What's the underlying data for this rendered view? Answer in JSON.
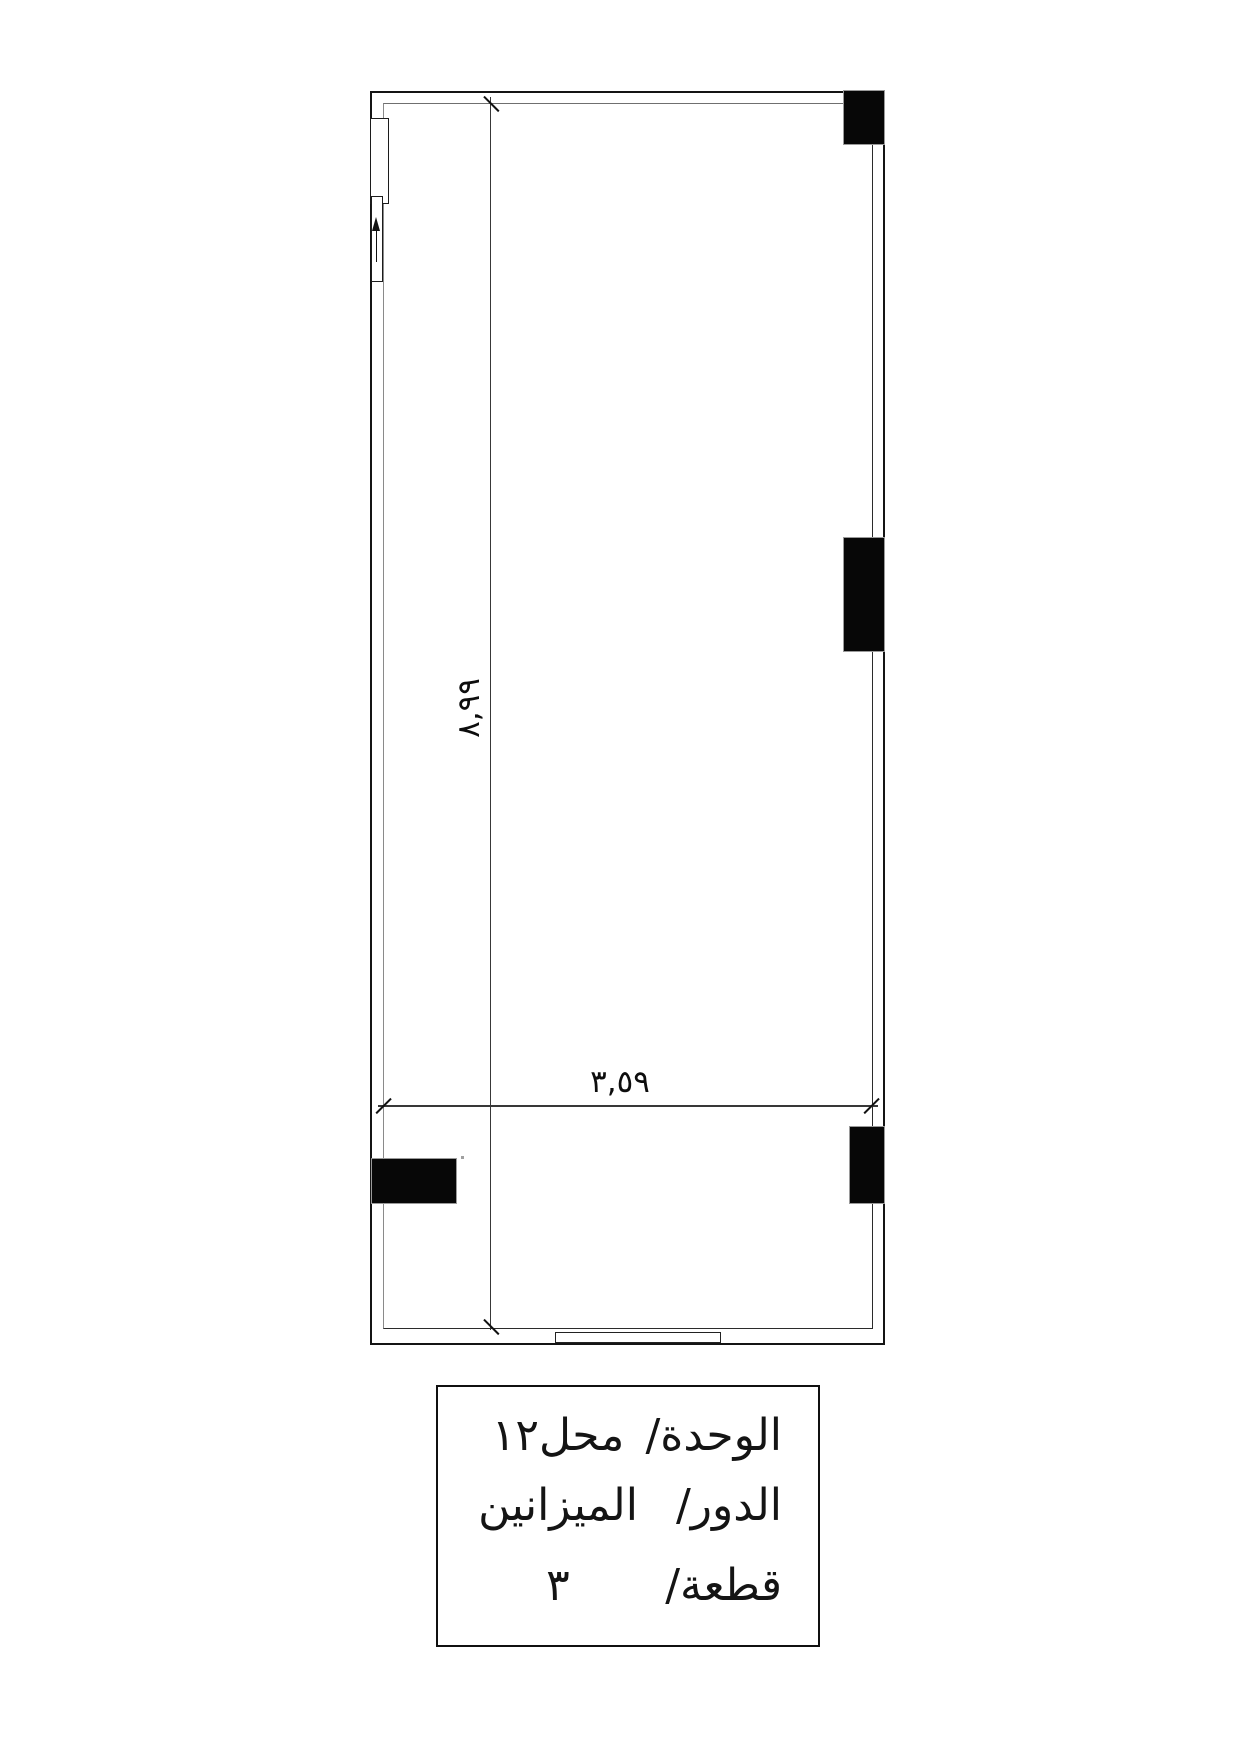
{
  "drawing": {
    "dimensions": {
      "vertical_label": "٨,٩٩",
      "horizontal_label": "٣,٥٩"
    },
    "title_block": {
      "rows": [
        {
          "label": "الوحدة/",
          "value": "محل١٢"
        },
        {
          "label": "الدور/",
          "value": "الميزانين"
        },
        {
          "label": "قطعة/",
          "value": "٣"
        }
      ]
    },
    "colors": {
      "line": "#141414",
      "column_fill": "#070707",
      "inner_line": "#8a8a8a",
      "background": "#ffffff"
    }
  }
}
